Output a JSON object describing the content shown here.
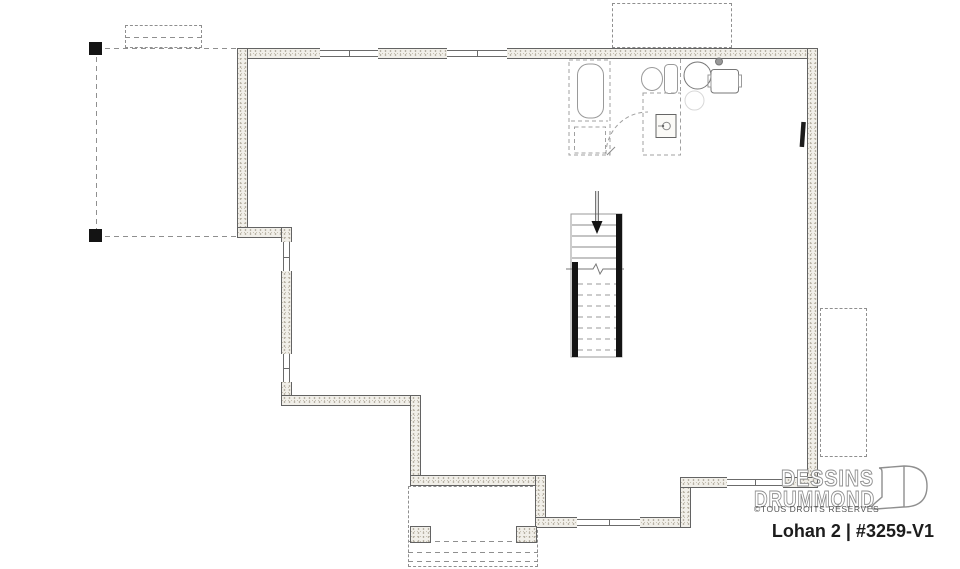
{
  "branding": {
    "studio_line1": "DESSINS",
    "studio_line2": "DRUMMOND",
    "rights": "©TOUS DROITS RÉSERVÉS",
    "plan_title": "Lohan 2 | #3259-V1"
  },
  "colors": {
    "wall_fill": "#f1efe9",
    "wall_border": "#636363",
    "dashed_gray": "#8f8f8f",
    "stair_wall_black": "#141414",
    "fixture_gray": "#9a9a9a",
    "title_text": "#1c1c1c",
    "logo_outline": "#8f8f8f"
  },
  "plan": {
    "walls": [
      {
        "x": 237,
        "y": 48,
        "w": 581,
        "h": 11
      },
      {
        "x": 807,
        "y": 48,
        "w": 11,
        "h": 440
      },
      {
        "x": 237,
        "y": 48,
        "w": 11,
        "h": 190
      },
      {
        "x": 237,
        "y": 227,
        "w": 55,
        "h": 11
      },
      {
        "x": 281,
        "y": 227,
        "w": 11,
        "h": 179
      },
      {
        "x": 281,
        "y": 395,
        "w": 139,
        "h": 11
      },
      {
        "x": 410,
        "y": 395,
        "w": 11,
        "h": 91
      },
      {
        "x": 410,
        "y": 475,
        "w": 136,
        "h": 11
      },
      {
        "x": 535,
        "y": 475,
        "w": 11,
        "h": 53
      },
      {
        "x": 535,
        "y": 517,
        "w": 156,
        "h": 11
      },
      {
        "x": 680,
        "y": 477,
        "w": 11,
        "h": 51
      },
      {
        "x": 680,
        "y": 477,
        "w": 138,
        "h": 11
      }
    ],
    "windows": [
      {
        "x": 320,
        "y": 48,
        "w": 58,
        "h": 11,
        "dir": "h"
      },
      {
        "x": 447,
        "y": 48,
        "w": 60,
        "h": 11,
        "dir": "h"
      },
      {
        "x": 281,
        "y": 242,
        "w": 11,
        "h": 29,
        "dir": "v"
      },
      {
        "x": 281,
        "y": 354,
        "w": 11,
        "h": 28,
        "dir": "v"
      },
      {
        "x": 577,
        "y": 517,
        "w": 63,
        "h": 11,
        "dir": "h"
      },
      {
        "x": 727,
        "y": 477,
        "w": 56,
        "h": 11,
        "dir": "h"
      }
    ],
    "dashed_rects": [
      {
        "name": "front-stoop-outline",
        "x": 125,
        "y": 25,
        "w": 77,
        "h": 23
      },
      {
        "name": "rear-porch-outline",
        "x": 612,
        "y": 3,
        "w": 120,
        "h": 45
      },
      {
        "name": "side-deck-outline",
        "x": 820,
        "y": 308,
        "w": 47,
        "h": 149
      },
      {
        "name": "porch-below-outline",
        "x": 408,
        "y": 486,
        "w": 130,
        "h": 81
      }
    ],
    "dashed_lines": [
      {
        "x1": 96,
        "y1": 48,
        "x2": 237,
        "y2": 48
      },
      {
        "x1": 96,
        "y1": 48,
        "x2": 96,
        "y2": 236
      },
      {
        "x1": 96,
        "y1": 236,
        "x2": 237,
        "y2": 236
      },
      {
        "x1": 125,
        "y1": 37,
        "x2": 202,
        "y2": 37
      },
      {
        "x1": 408,
        "y1": 541,
        "x2": 538,
        "y2": 541
      },
      {
        "x1": 408,
        "y1": 552,
        "x2": 538,
        "y2": 552
      },
      {
        "x1": 408,
        "y1": 561,
        "x2": 538,
        "y2": 561
      }
    ],
    "piers": [
      {
        "x": 410,
        "y": 526,
        "w": 21,
        "h": 17
      },
      {
        "x": 516,
        "y": 526,
        "w": 21,
        "h": 17
      }
    ],
    "posts": [
      {
        "x": 89,
        "y": 42,
        "w": 13,
        "h": 13
      },
      {
        "x": 89,
        "y": 229,
        "w": 13,
        "h": 13
      }
    ],
    "fixtures": [
      "bathtub",
      "toilet",
      "shower-base",
      "water-heater",
      "washer",
      "staircase-down",
      "door-swing",
      "electrical-panel"
    ]
  }
}
